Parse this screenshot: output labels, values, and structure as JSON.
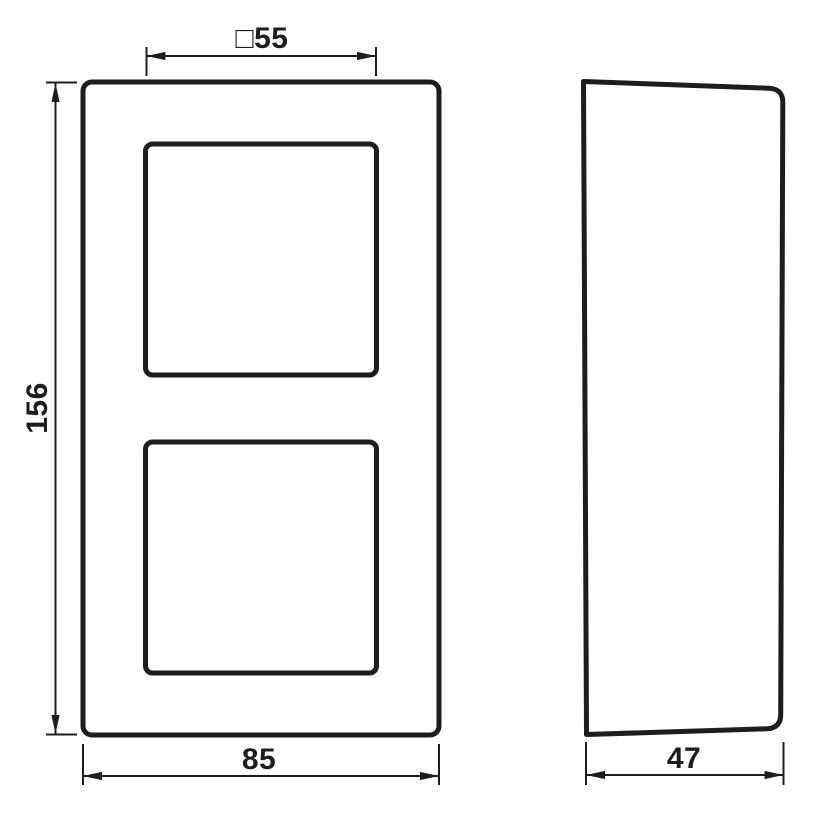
{
  "drawing": {
    "kind": "technical-dimension-drawing",
    "subject": "2-gang cover frame with two square module openings, front view and side profile view",
    "colors": {
      "line": "#1d1d1b",
      "background": "#ffffff"
    },
    "views": {
      "front": {
        "name": "front view",
        "dims": {
          "cutout": {
            "label": "□55",
            "value": 55,
            "meaning": "square opening size"
          },
          "height": {
            "label": "156",
            "value": 156,
            "meaning": "overall frame height"
          },
          "width": {
            "label": "85",
            "value": 85,
            "meaning": "overall frame width"
          }
        }
      },
      "side": {
        "name": "side profile view",
        "dims": {
          "depth": {
            "label": "47",
            "value": 47,
            "meaning": "overall depth"
          }
        }
      }
    }
  }
}
